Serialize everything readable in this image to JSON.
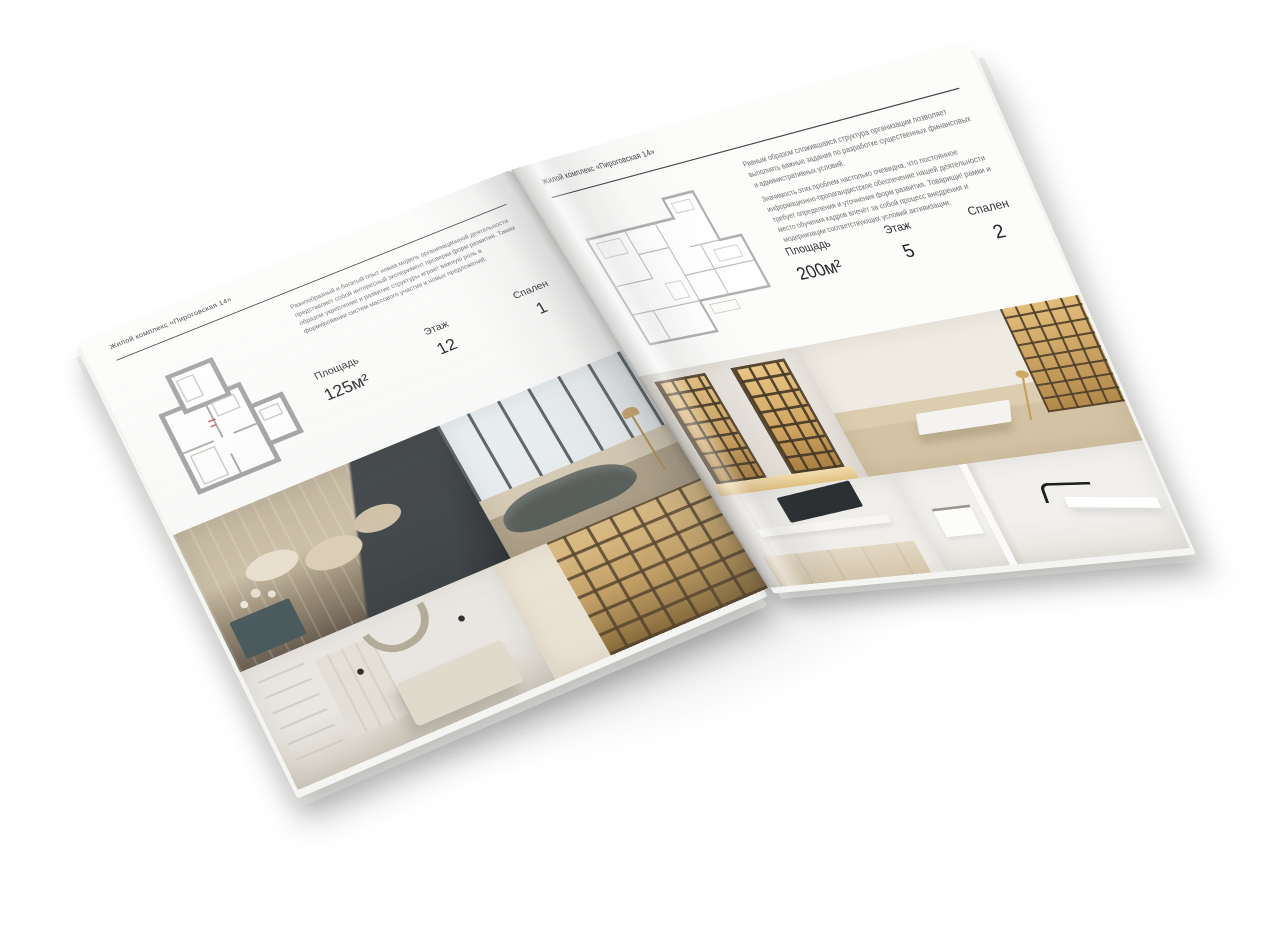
{
  "scene": {
    "background": "#ffffff"
  },
  "brochure": {
    "left_page": {
      "header": "Жилой комплекс «Пироговская 14»",
      "description": "Разнообразный и богатый опыт новая модель организационной деятельности представляет собой интересный эксперимент проверки форм развития. Таким образом укрепление и развитие структуры играет важную роль в формировании систем массового участия и новых предложений.",
      "stats": [
        {
          "label": "Площадь",
          "value": "125м²"
        },
        {
          "label": "Этаж",
          "value": "12"
        },
        {
          "label": "Спален",
          "value": "1"
        }
      ],
      "photos": [
        "bedroom",
        "living-room",
        "white-bedroom",
        "hall-bookshelf"
      ]
    },
    "right_page": {
      "header": "Жилой комплекс «Пироговская 14»",
      "description_1": "Равным образом сложившаяся структура организации позволяет выполнять важные задания по разработке существенных финансовых и административных условий.",
      "description_2": "Значимость этих проблем настолько очевидна, что постоянное информационно-пропагандистское обеспечение нашей деятельности требует определения и уточнения форм развития. Товарищи! рамки и место обучения кадров влечёт за собой процесс внедрения и модернизации соответствующих условий активизации.",
      "stats": [
        {
          "label": "Площадь",
          "value": "200м²"
        },
        {
          "label": "Этаж",
          "value": "5"
        },
        {
          "label": "Спален",
          "value": "2"
        }
      ],
      "photos": [
        "wardrobe",
        "study",
        "kitchen",
        "bathroom"
      ]
    },
    "palette": {
      "page_white": "#fcfcfb",
      "plan_wall_gray": "#a2a2a2",
      "plan_light_gray": "#b8b8b8",
      "warm_wood": "#c9a86b",
      "dark_furniture": "#3e4346",
      "text_dark": "#3c3c3c",
      "text_muted": "#6e6e6e"
    }
  }
}
